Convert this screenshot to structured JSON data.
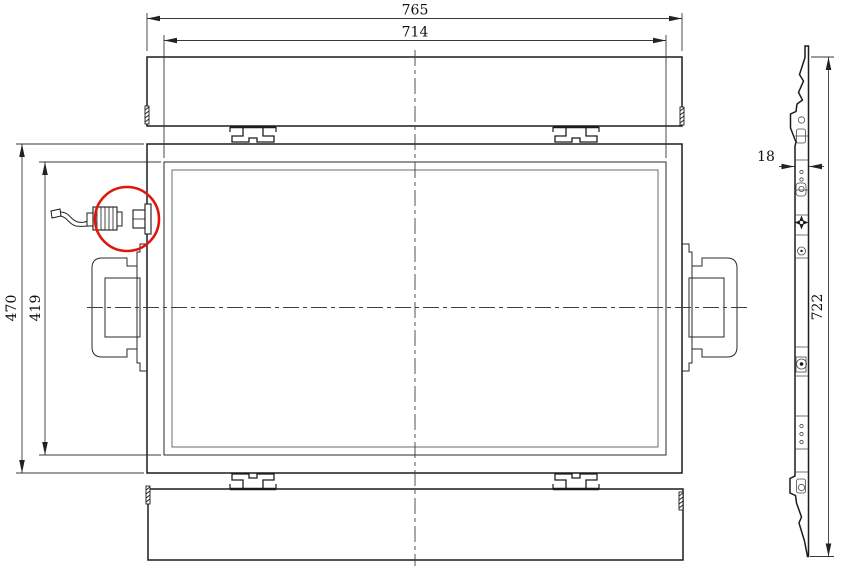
{
  "colors": {
    "background": "#ffffff",
    "line": "#1c1c1c",
    "dim_line": "#383838",
    "highlight": "#e0150d"
  },
  "front_view": {
    "dim_overall_width": "765",
    "dim_inner_width": "714",
    "dim_overall_height": "470",
    "dim_inner_height": "419"
  },
  "side_view": {
    "dim_depth": "18",
    "dim_height": "722"
  }
}
